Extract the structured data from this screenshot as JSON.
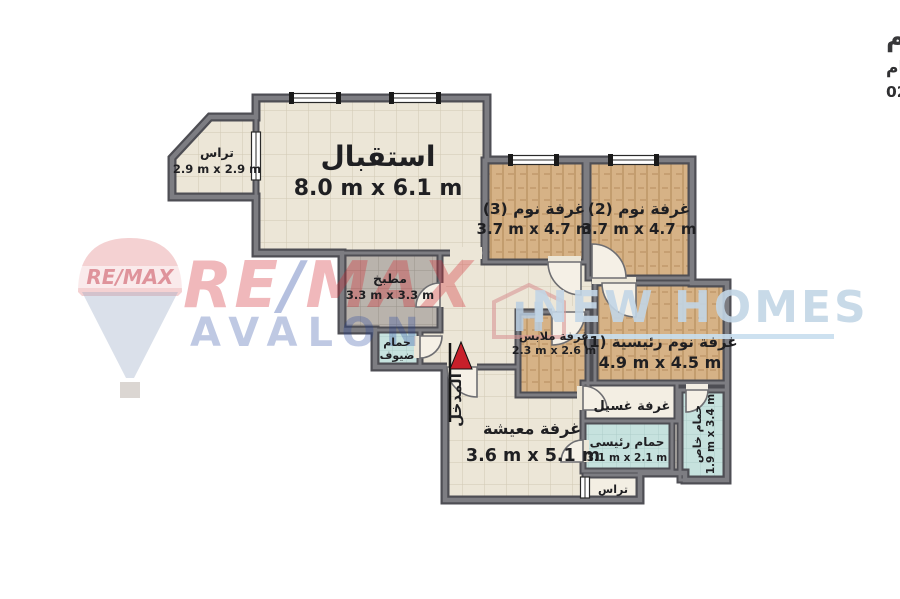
{
  "header": {
    "title": "شقة للبيع - سموحة - مروج - 230 م",
    "subtitle": "4غرف + 4 رسيبشن + 3 حمام",
    "code": "كود : 020560"
  },
  "rooms": {
    "terrace_top": {
      "name": "تراس",
      "dims": "2.9 m x 2.9 m"
    },
    "reception": {
      "name": "استقبال",
      "dims": "8.0 m x 6.1 m"
    },
    "bedroom3": {
      "name": "غرفة نوم (3)",
      "dims": "3.7 m x 4.7 m"
    },
    "bedroom2": {
      "name": "غرفة نوم (2)",
      "dims": "3.7 m x 4.7 m"
    },
    "master_bedroom": {
      "name": "غرفة نوم رئيسية (1)",
      "dims": "4.9 m x 4.5 m"
    },
    "kitchen": {
      "name": "مطبخ",
      "dims": "3.3 m x 3.3 m"
    },
    "guest_bath": {
      "line1": "حمام",
      "line2": "ضيوف"
    },
    "dressing": {
      "name": "غرفة ملابس",
      "dims": "2.3 m x 2.6 m"
    },
    "living": {
      "name": "غرفة معيشة",
      "dims": "3.6 m x 5.1 m"
    },
    "laundry": {
      "name": "غرفة غسيل"
    },
    "master_bath": {
      "name": "حمام رئيسى",
      "dims": "3.1 m x 2.1 m"
    },
    "private_bath": {
      "name": "حمام خاص",
      "dims": "1.9 m x 3.4 m"
    },
    "terrace_bottom": {
      "name": "تراس"
    },
    "entrance": {
      "name": "المدخل"
    }
  },
  "watermarks": {
    "balloon_text": "RE/MAX",
    "remax_re": "RE",
    "remax_slash": "/",
    "remax_max": "MAX",
    "avalon": "AVALON",
    "logo_letter": "H",
    "new_homes": "NEW HOMES"
  },
  "colors": {
    "wall": "#6f6f73",
    "floor_tile": "#ece6d7",
    "wood": "#d6b286",
    "bath_tile": "#c6e2de",
    "kitchen_tile": "#b9b3ac",
    "entrance_arrow": "#c8202a",
    "watermark_red": "#d22630",
    "watermark_blue": "#1d3f9e",
    "newhomes_blue": "#c3d6e6"
  }
}
